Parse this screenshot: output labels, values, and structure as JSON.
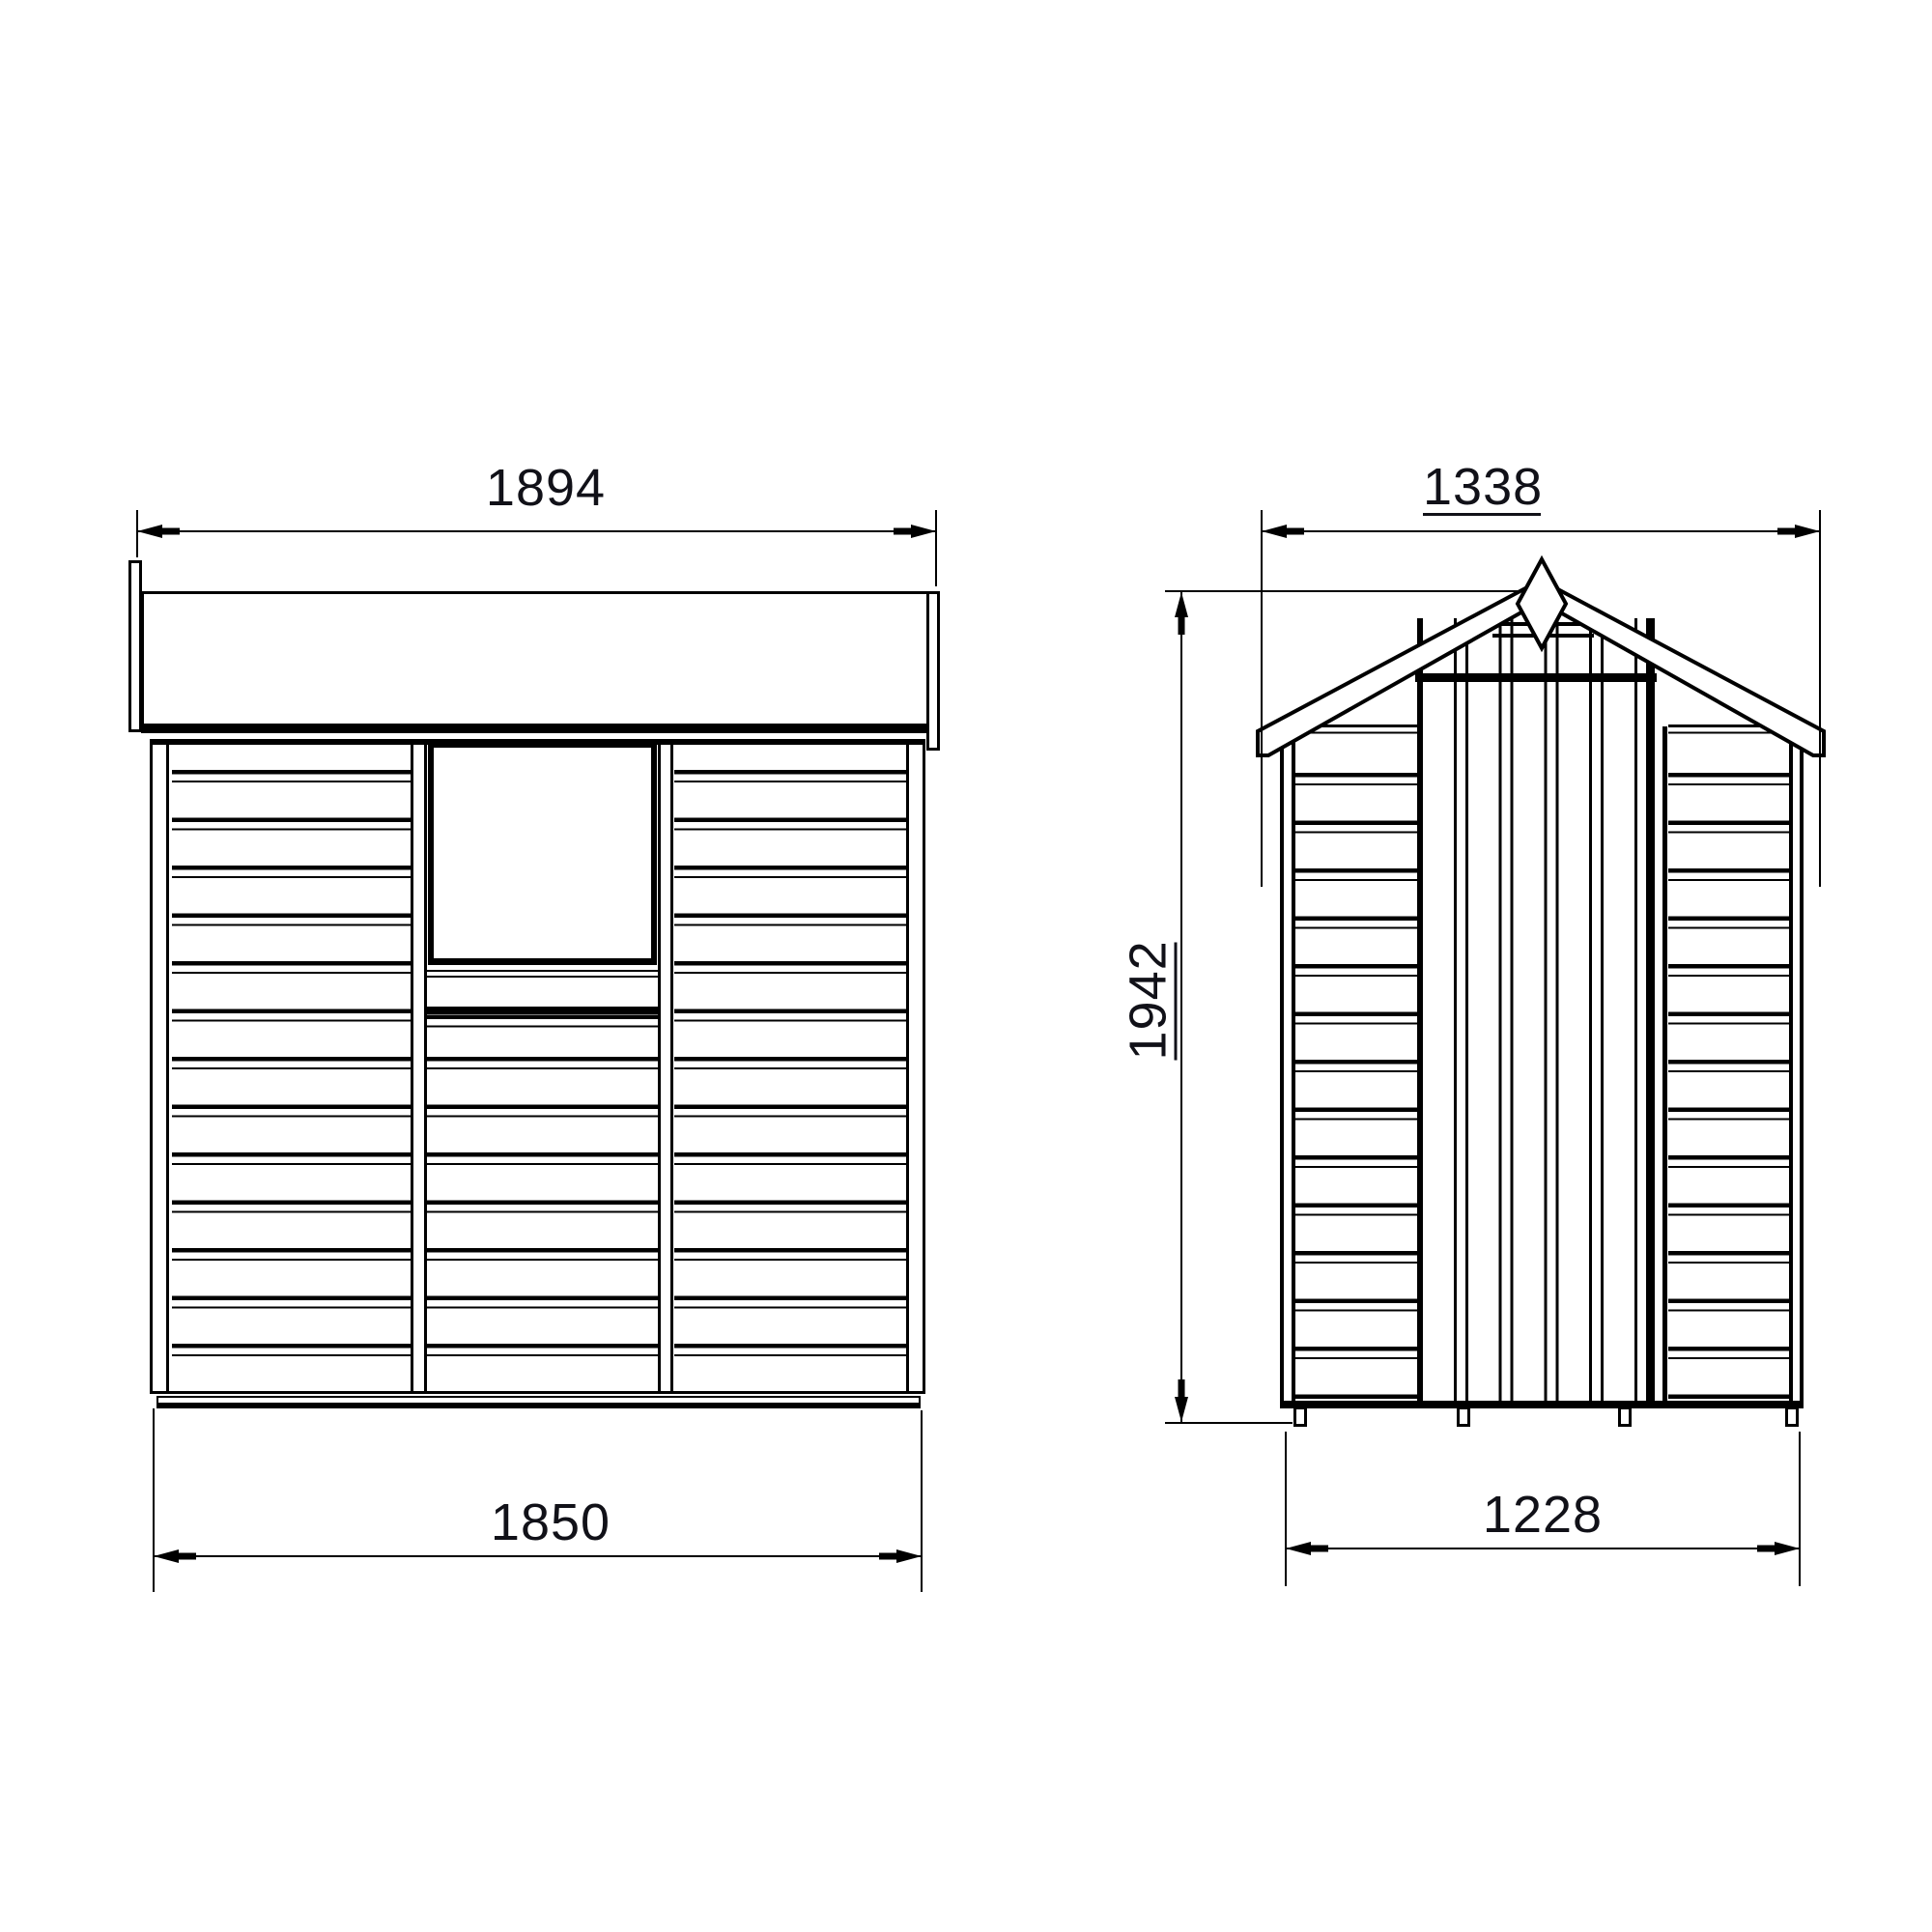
{
  "drawing": {
    "background_color": "#ffffff",
    "line_color": "#000000",
    "text_color": "#111118",
    "side_view": {
      "dim_width_overall": "1894",
      "dim_width_base": "1850"
    },
    "front_view": {
      "dim_width_overall": "1338",
      "dim_height_overall": "1942",
      "dim_width_base": "1228"
    }
  }
}
